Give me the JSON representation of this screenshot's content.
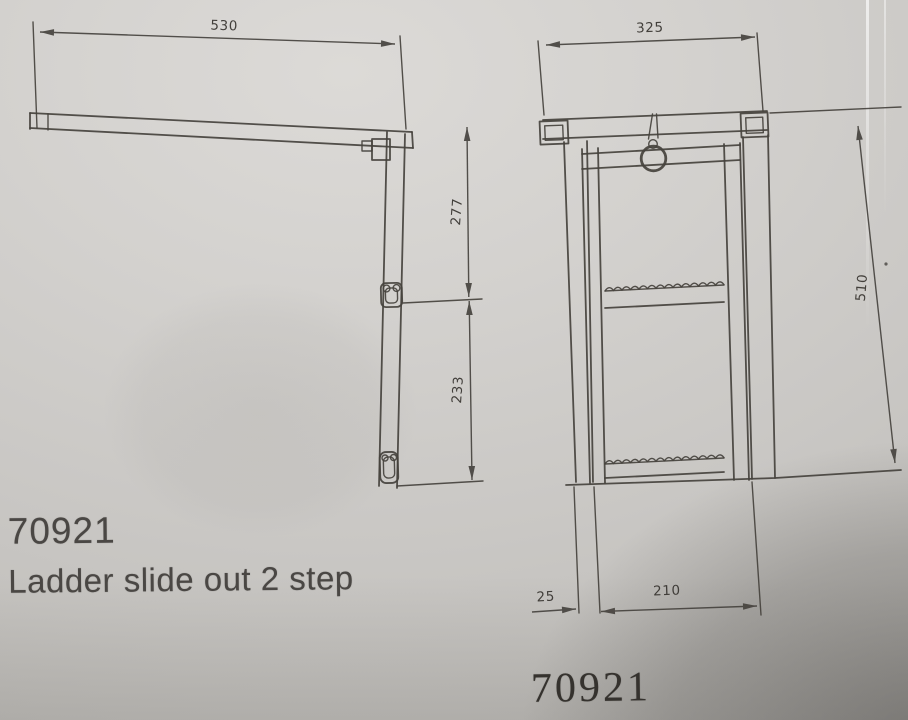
{
  "labels": {
    "product_code": "70921",
    "product_name": "Ladder slide out 2 step",
    "drawing_number": "70921"
  },
  "side_view": {
    "dim_overall_width": "530",
    "dim_upper_height": "277",
    "dim_lower_height": "233"
  },
  "front_view": {
    "dim_overall_width": "325",
    "dim_overall_height": "510",
    "dim_rail_offset": "25",
    "dim_inner_width": "210"
  },
  "colors": {
    "ink": "#45423d",
    "paper_light": "#d8d6d3",
    "paper_shadow": "#8f8c89"
  }
}
